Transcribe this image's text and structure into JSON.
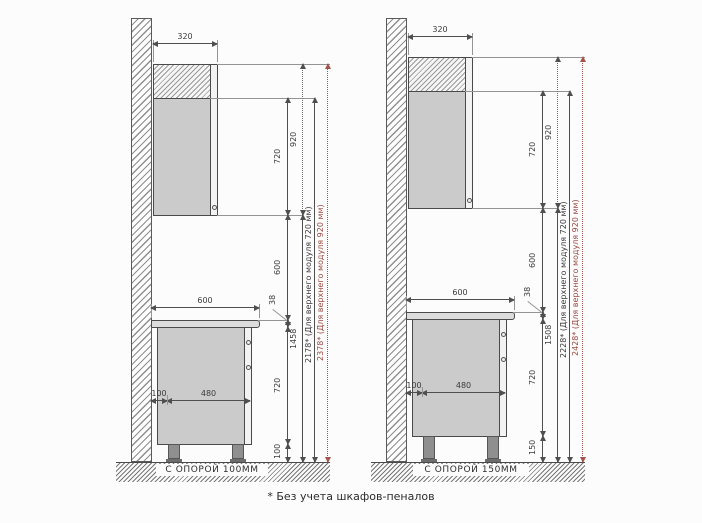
{
  "caption": "* Без учета шкафов-пеналов",
  "colors": {
    "line": "#4a4a4a",
    "red_accent": "#9c4a42",
    "cabinet_fill": "#cbcbcb",
    "countertop_fill": "#dcdcdc"
  },
  "diagrams": [
    {
      "floor_label": "С ОПОРОЙ 100ММ",
      "dims": {
        "top_width": "320",
        "upper_h": "720",
        "upper_h_tall": "920",
        "gap": "600",
        "counter_w": "600",
        "counter_t": "38",
        "base_h": "720",
        "leg_h": "100",
        "back_gap": "100",
        "base_depth": "480",
        "floor_to_upper": "1458",
        "total_720": "2178* (Для верхнего модуля 720 мм)",
        "total_920": "2378* (Для верхнего модуля 920 мм)"
      }
    },
    {
      "floor_label": "С ОПОРОЙ 150ММ",
      "dims": {
        "top_width": "320",
        "upper_h": "720",
        "upper_h_tall": "920",
        "gap": "600",
        "counter_w": "600",
        "counter_t": "38",
        "base_h": "720",
        "leg_h": "150",
        "back_gap": "100",
        "base_depth": "480",
        "floor_to_upper": "1508",
        "total_720": "2228* (Для верхнего модуля 720 мм)",
        "total_920": "2428* (Для верхнего модуля 920 мм)"
      }
    }
  ]
}
